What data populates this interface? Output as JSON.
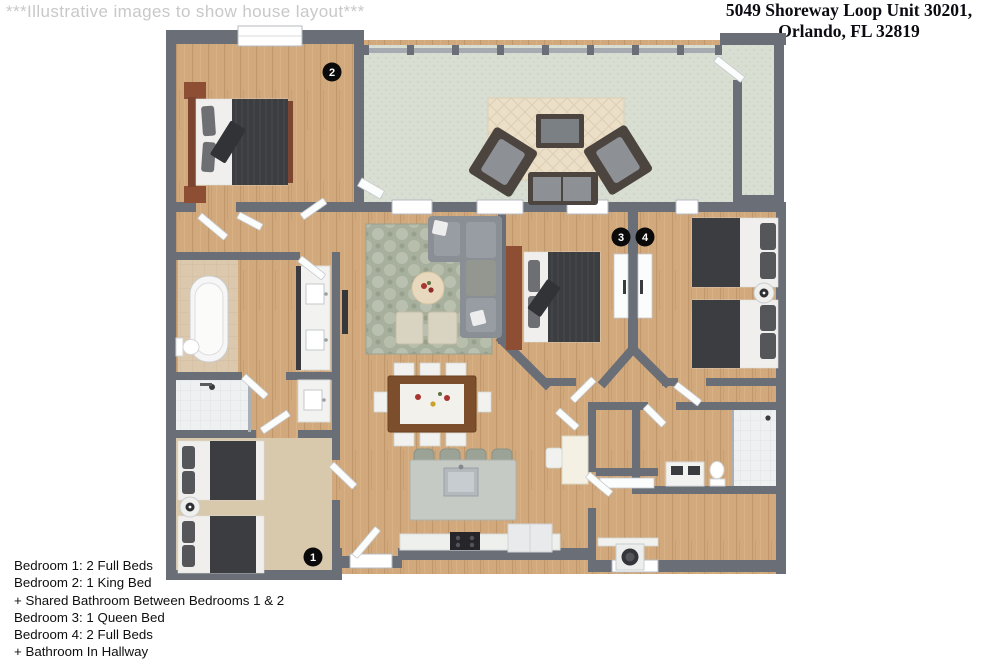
{
  "watermark": "***Illustrative images to show house layout***",
  "title": {
    "line1": "5049 Shoreway Loop Unit 30201,",
    "line2": "Orlando, FL 32819"
  },
  "legend": {
    "lines": [
      "Bedroom 1: 2 Full Beds",
      "Bedroom 2: 1 King Bed",
      "+ Shared Bathroom Between Bedrooms 1 & 2",
      "Bedroom 3: 1 Queen Bed",
      "Bedroom 4: 2 Full Beds",
      "+ Bathroom In Hallway"
    ]
  },
  "markers": [
    {
      "label": "1"
    },
    {
      "label": "2"
    },
    {
      "label": "3"
    },
    {
      "label": "4"
    }
  ],
  "colors": {
    "wall": "#696e77",
    "wood_floor": "#d1a97c",
    "patio_tile": "#d9ded3",
    "carpet": "#d9c9ac",
    "duvet_dark": "#3c3d41",
    "marker_bg": "#0a0a0a"
  }
}
